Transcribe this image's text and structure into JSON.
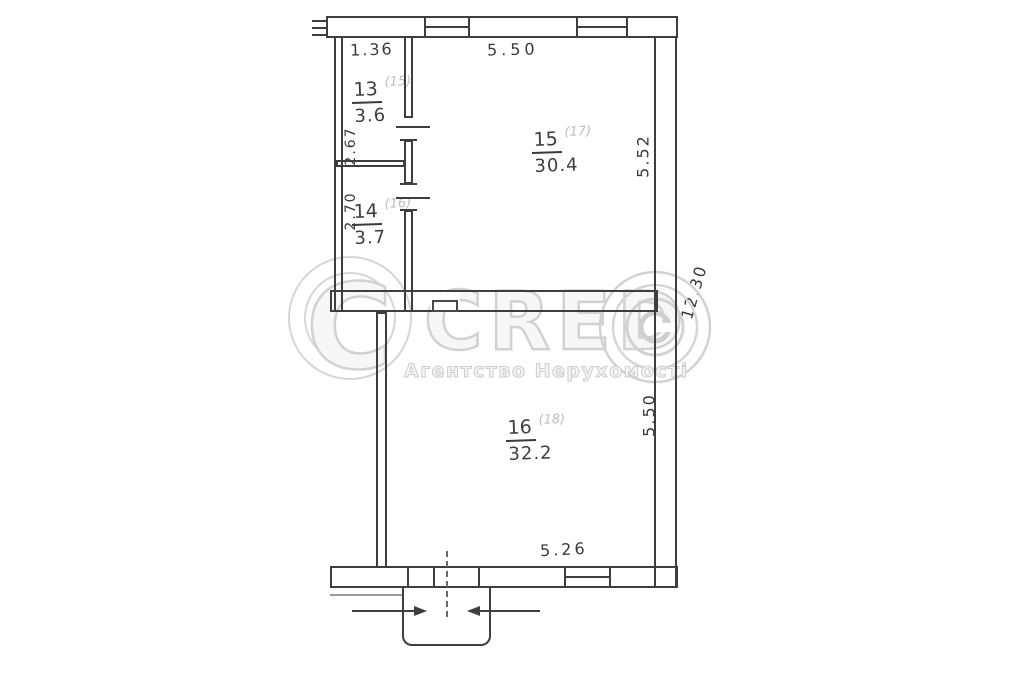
{
  "canvas": {
    "background": "#ffffff",
    "ink": "#3e3e3e"
  },
  "watermark": {
    "brand": "CRED",
    "logo": "concentric-circles-copyright-mark",
    "subtitle": "Агентство Нерухомості",
    "color": "#d2d2d2"
  },
  "rooms": {
    "room13": {
      "number": "13",
      "alt_number": "(15)",
      "area": "3.6"
    },
    "room14": {
      "number": "14",
      "alt_number": "(16)",
      "area": "3.7"
    },
    "room15": {
      "number": "15",
      "alt_number": "(17)",
      "area": "30.4"
    },
    "room16": {
      "number": "16",
      "alt_number": "(18)",
      "area": "32.2"
    }
  },
  "dimensions": {
    "top_left_width": "1.36",
    "top_width": "5.50",
    "room13_depth": "2.67",
    "room14_depth": "2.70",
    "room15_depth": "5.52",
    "right_overall": "12.30",
    "room16_depth": "5.50",
    "bottom_width": "5.26"
  }
}
